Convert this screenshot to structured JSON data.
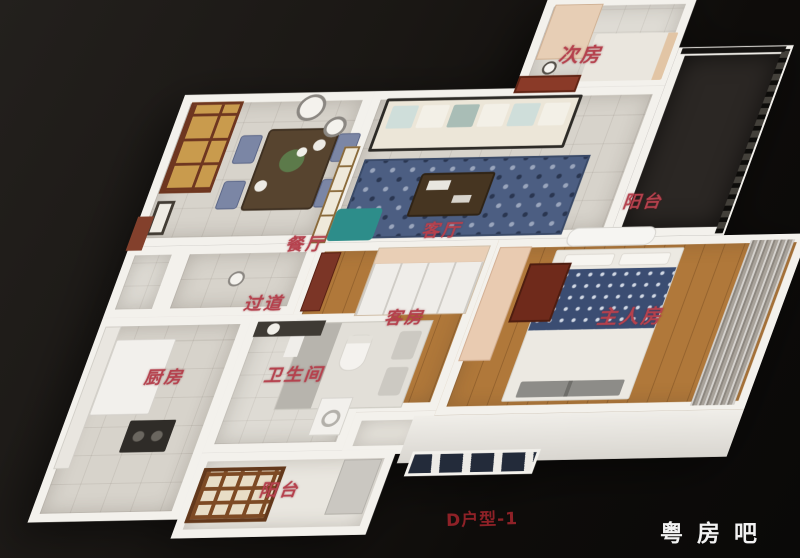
{
  "floorplan": {
    "label_color": "#b5414d",
    "wall_color": "#f3f1ec",
    "rooms": [
      {
        "id": "dining-room",
        "label": "餐厅"
      },
      {
        "id": "living-room",
        "label": "客厅"
      },
      {
        "id": "secondary-bedroom",
        "label": "次房"
      },
      {
        "id": "balcony-right",
        "label": "阳台"
      },
      {
        "id": "hallway",
        "label": "过道"
      },
      {
        "id": "guest-bedroom",
        "label": "客房"
      },
      {
        "id": "master-bedroom",
        "label": "主人房"
      },
      {
        "id": "kitchen",
        "label": "厨房"
      },
      {
        "id": "bathroom",
        "label": "卫生间"
      },
      {
        "id": "balcony-bottom",
        "label": "阳台"
      }
    ]
  },
  "captions": {
    "unit_label": "D户型-1",
    "unit_label_color": "#8e2127",
    "watermark": "粤房吧",
    "watermark_color": "#f2f2f2"
  },
  "palette": {
    "background": "#15120f",
    "wood_floor": "#b0783a",
    "tile_floor": "#d7d3cb",
    "rug_blue": "#4c5e82",
    "balcony_dark": "#2b2724",
    "accent_door_red": "#8a3a28"
  }
}
